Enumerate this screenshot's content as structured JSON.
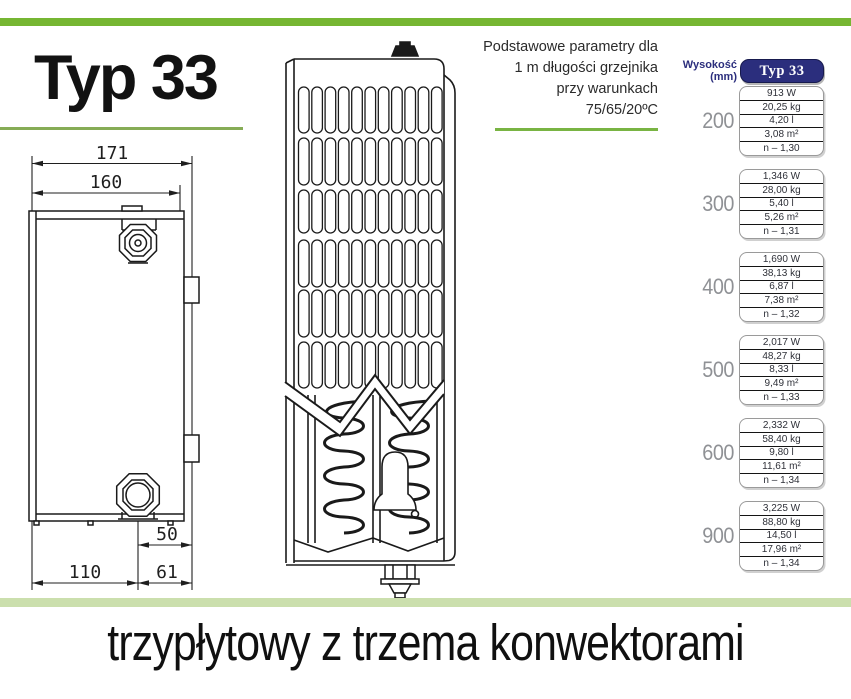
{
  "header": {
    "title": "Typ 33",
    "note_lines": [
      "Podstawowe parametry dla",
      "1 m długości grzejnika",
      "przy warunkach",
      "75/65/20ºC"
    ]
  },
  "table": {
    "height_header": "Wysokość (mm)",
    "type_header": "Typ 33",
    "groups": [
      {
        "height": "200",
        "values": [
          "913 W",
          "20,25 kg",
          "4,20 l",
          "3,08 m²",
          "n – 1,30"
        ]
      },
      {
        "height": "300",
        "values": [
          "1,346 W",
          "28,00 kg",
          "5,40 l",
          "5,26 m²",
          "n – 1,31"
        ]
      },
      {
        "height": "400",
        "values": [
          "1,690 W",
          "38,13 kg",
          "6,87 l",
          "7,38 m²",
          "n – 1,32"
        ]
      },
      {
        "height": "500",
        "values": [
          "2,017 W",
          "48,27 kg",
          "8,33 l",
          "9,49 m²",
          "n – 1,33"
        ]
      },
      {
        "height": "600",
        "values": [
          "2,332 W",
          "58,40 kg",
          "9,80 l",
          "11,61 m²",
          "n – 1,34"
        ]
      },
      {
        "height": "900",
        "values": [
          "3,225 W",
          "88,80 kg",
          "14,50 l",
          "17,96 m²",
          "n – 1,34"
        ]
      }
    ]
  },
  "drawing": {
    "dim_depth_total": "171",
    "dim_depth_body": "160",
    "dim_offset": "50",
    "dim_left": "110",
    "dim_right": "61"
  },
  "footer": {
    "caption": "trzypłytowy z trzema konwektorami"
  },
  "colors": {
    "green": "#76b632",
    "pale_green": "#cbdfad",
    "underline_green": "#86ac56",
    "underline_green2": "#79b443",
    "navy": "#2b2e7d",
    "gray_label": "#8f9195",
    "ink": "#1a1a1a"
  }
}
